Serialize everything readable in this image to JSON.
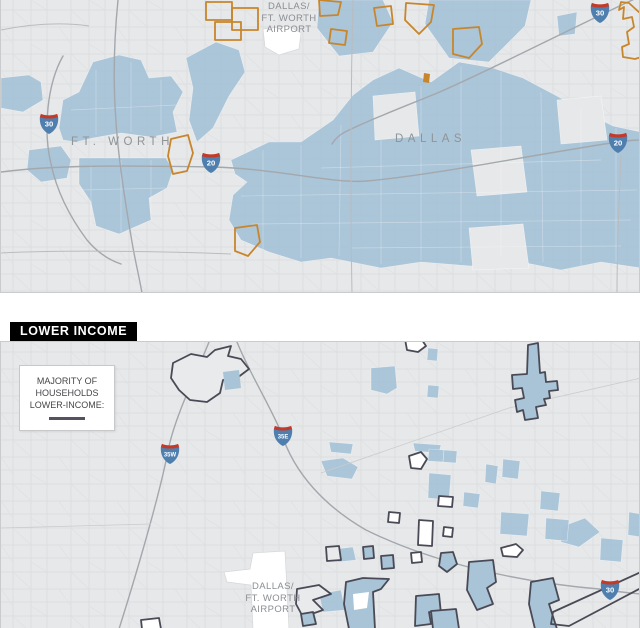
{
  "badge": {
    "label": "LOWER INCOME"
  },
  "legend": {
    "lines": [
      "MAJORITY OF",
      "HOUSEHOLDS",
      "LOWER-INCOME:"
    ]
  },
  "top_map": {
    "airport_label": {
      "lines": [
        "DALLAS/",
        "FT. WORTH",
        "AIRPORT"
      ]
    },
    "cities": [
      {
        "name": "FT. WORTH"
      },
      {
        "name": "DALLAS"
      }
    ],
    "shields": [
      {
        "label": "30"
      },
      {
        "label": "20"
      },
      {
        "label": "30"
      },
      {
        "label": "20"
      }
    ]
  },
  "bottom_map": {
    "airport_label": {
      "lines": [
        "DALLAS/",
        "FT. WORTH",
        "AIRPORT"
      ]
    },
    "shields": [
      {
        "label": "35W"
      },
      {
        "label": "35E"
      },
      {
        "label": "30"
      }
    ]
  },
  "colors": {
    "tract_blue": "#a9c4d7",
    "outline_orange": "#c8862c",
    "outline_dark": "#4a4a57",
    "map_background": "#e7e8e9",
    "badge_background": "#000000",
    "legend_line": "#56505f",
    "shield_red": "#c23b2a",
    "shield_blue": "#4f7fae"
  }
}
